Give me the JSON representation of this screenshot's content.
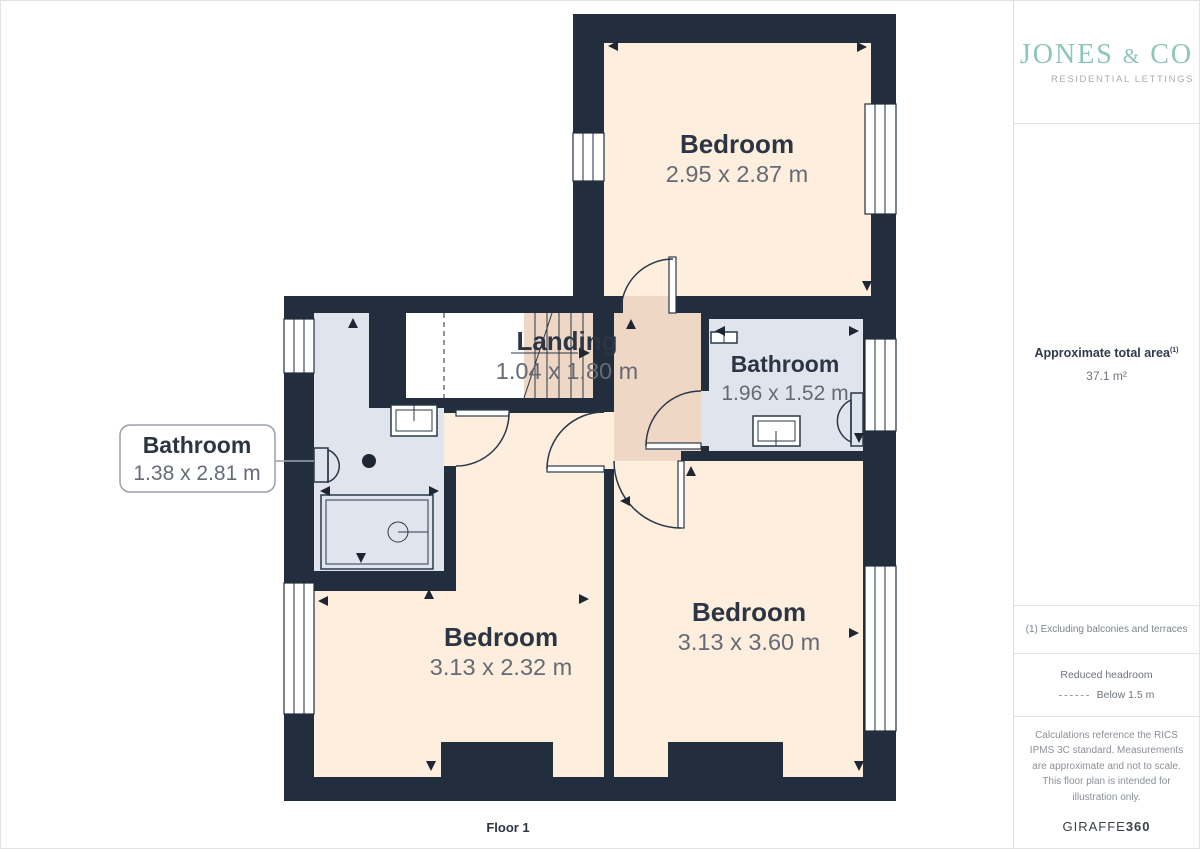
{
  "branding": {
    "logo_word1": "JONES",
    "logo_amp": "&",
    "logo_word2": "CO",
    "logo_sub": "RESIDENTIAL LETTINGS"
  },
  "sidebar": {
    "area_label": "Approximate total area",
    "area_footnote_ref": "(1)",
    "area_value": "37.1 m²",
    "footnote": "(1) Excluding balconies and terraces",
    "reduced_headroom_title": "Reduced headroom",
    "reduced_headroom_value": "Below 1.5 m",
    "disclaimer": "Calculations reference the RICS IPMS 3C standard. Measurements are approximate and not to scale. This floor plan is intended for illustration only.",
    "provider": "GIRAFFE",
    "provider_suffix": "360"
  },
  "floor_label": "Floor 1",
  "rooms": [
    {
      "name": "Bedroom",
      "dimensions": "2.95 x 2.87 m"
    },
    {
      "name": "Landing",
      "dimensions": "1.04 x 1.80 m"
    },
    {
      "name": "Bathroom",
      "dimensions": "1.96 x 1.52 m"
    },
    {
      "name": "Bathroom",
      "dimensions": "1.38 x 2.81 m"
    },
    {
      "name": "Bedroom",
      "dimensions": "3.13 x 2.32 m"
    },
    {
      "name": "Bedroom",
      "dimensions": "3.13 x 3.60 m"
    }
  ],
  "colors": {
    "wall": "#222e3d",
    "room_cream": "#fdeedd",
    "landing_tan": "#eed7c4",
    "bathroom_blue": "#dfe4ed",
    "line": "#2b3849",
    "room_name_text": "#2c3543",
    "dimension_text": "#656b76",
    "logo_teal": "#8cc5ba"
  }
}
